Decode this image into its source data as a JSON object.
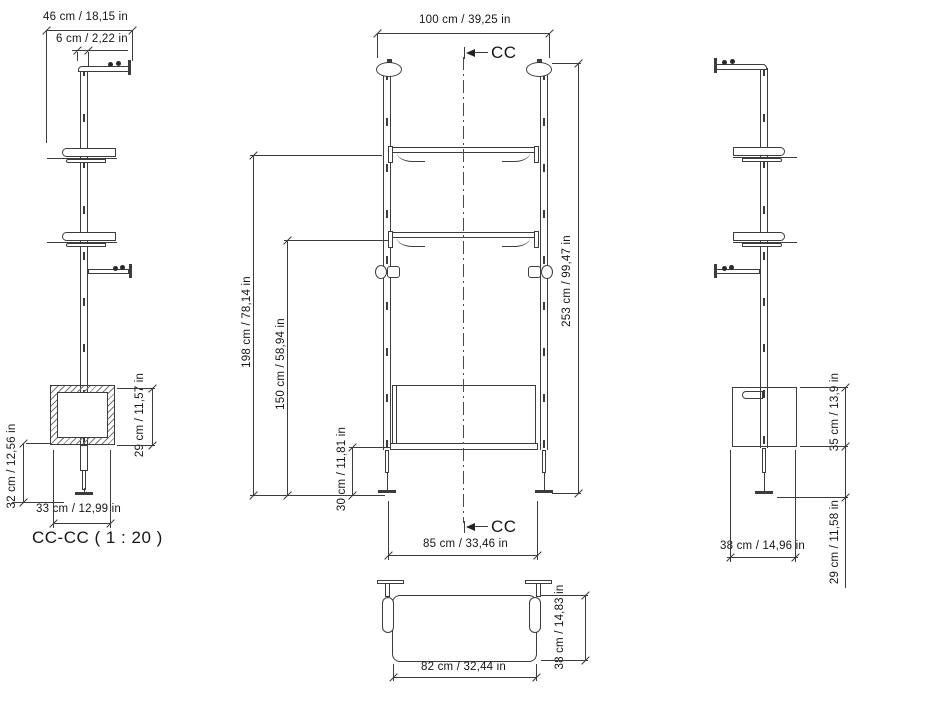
{
  "colors": {
    "background": "#ffffff",
    "line": "#3c3c3c",
    "text": "#161616"
  },
  "views": {
    "section": {
      "label": "CC-CC ( 1 : 20 )",
      "dim_bracket_depth": "46 cm / 18,15 in",
      "dim_pole_offset": "6 cm / 2,22 in",
      "dim_box_height": "29 cm / 11,57 in",
      "dim_box_to_floor": "32 cm / 12,56 in",
      "dim_box_width": "33 cm / 12,99 in"
    },
    "front": {
      "marker_top": "CC",
      "marker_bottom": "CC",
      "dim_outer_width": "100 cm / 39,25 in",
      "dim_total_height": "253 cm / 99,47 in",
      "dim_shelf1_height": "198 cm / 78,14 in",
      "dim_shelf2_height": "150 cm / 58,94 in",
      "dim_desk_clearance": "30 cm / 11,81 in",
      "dim_inner_width": "85 cm / 33,46 in"
    },
    "side": {
      "dim_box_height": "35 cm / 13,9 in",
      "dim_box_to_floor": "29 cm / 11,58 in",
      "dim_depth": "38 cm / 14,96 in"
    },
    "plan": {
      "dim_panel_width": "82 cm / 32,44 in",
      "dim_panel_depth": "38 cm / 14,83 in"
    }
  }
}
